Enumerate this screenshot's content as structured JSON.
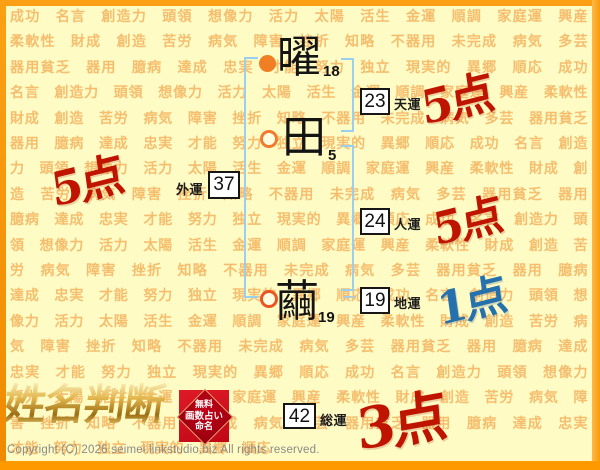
{
  "site": {
    "logo_text": "姓名判断",
    "badge": {
      "line1": "無料",
      "line2": "画数占い",
      "line3": "命名"
    },
    "copyright": "Copyright (C) 2026 seimei.linkstudio.biz All rights reserved."
  },
  "name": {
    "characters": [
      {
        "char": "曜",
        "strokes": "18"
      },
      {
        "char": "田",
        "strokes": "5"
      },
      {
        "char": "繭",
        "strokes": "19"
      }
    ]
  },
  "fortunes": [
    {
      "id": "tenun",
      "label": "天運",
      "value": "23",
      "score": "5点",
      "score_color": "#BE1400"
    },
    {
      "id": "jinun",
      "label": "人運",
      "value": "24",
      "score": "5点",
      "score_color": "#BE1400"
    },
    {
      "id": "chiun",
      "label": "地運",
      "value": "19",
      "score": "1点",
      "score_color": "#2471AE"
    },
    {
      "id": "gaiun",
      "label": "外運",
      "value": "37",
      "score": "5点",
      "score_color": "#BE1400"
    },
    {
      "id": "souun",
      "label": "総運",
      "value": "42",
      "score": "3点",
      "score_color": "#BE1400"
    }
  ],
  "background": {
    "watermark_words": [
      "成功",
      "名言",
      "創造力",
      "頭領",
      "想像力",
      "活力",
      "太陽",
      "活生",
      "金運",
      "順調",
      "家庭運",
      "興産",
      "柔軟性",
      "財成",
      "創造",
      "苦労",
      "病気",
      "障害",
      "挫折",
      "知略",
      "不器用",
      "未完成",
      "病気",
      "多芸",
      "器用貧乏",
      "器用",
      "臆病",
      "達成",
      "忠実",
      "才能",
      "努力",
      "独立",
      "現実的",
      "異郷",
      "順応"
    ],
    "repeat": 6
  },
  "colors": {
    "canvas_bg": "#FFFBC4",
    "frame_orange": "#FBA014",
    "bottom_bar": "#FF9900",
    "watermark_text": "#F5BE6F",
    "bracket_blue": "#9CCEF0",
    "marker_orange": "#F07E24",
    "score_red": "#BE1400",
    "score_blue": "#2471AE",
    "badge_red": "#C00716",
    "logo_gold": "#C9932B"
  }
}
